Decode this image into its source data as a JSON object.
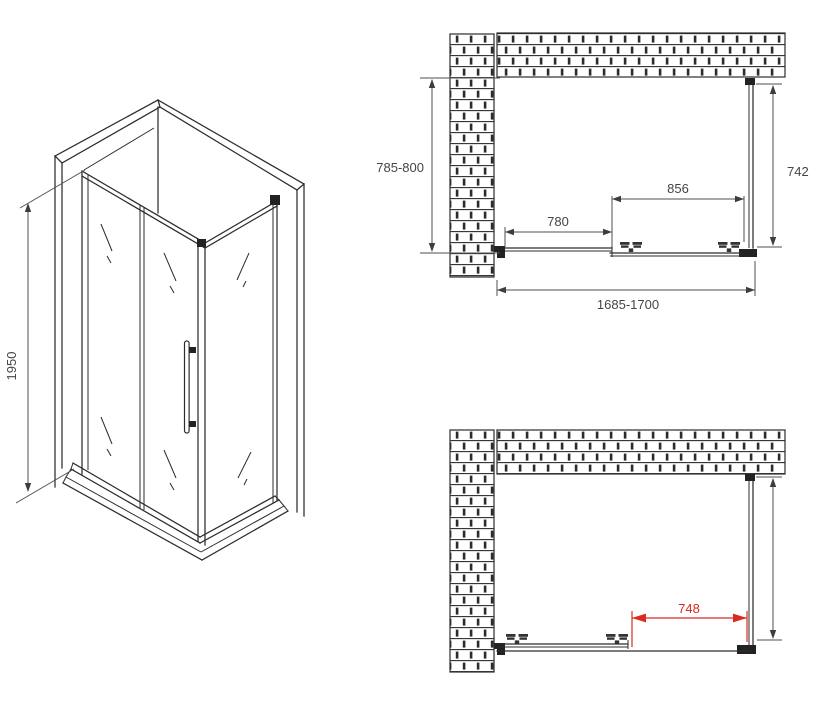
{
  "title": "Shower enclosure dimensional drawing",
  "colors": {
    "line": "#2c2c2c",
    "dimension_line": "#4f4f4f",
    "accent_red": "#d92921",
    "background": "#ffffff"
  },
  "views": {
    "isometric": {
      "name": "isometric-view",
      "dimensions": {
        "height": "1950"
      }
    },
    "plan_closed": {
      "name": "plan-view-door-closed",
      "dimensions": {
        "depth": "785-800",
        "side_panel": "742",
        "fixed_panel": "780",
        "door_panel": "856",
        "overall_width": "1685-1700"
      }
    },
    "plan_open": {
      "name": "plan-view-door-open",
      "dimensions": {
        "opening": "748"
      }
    }
  }
}
